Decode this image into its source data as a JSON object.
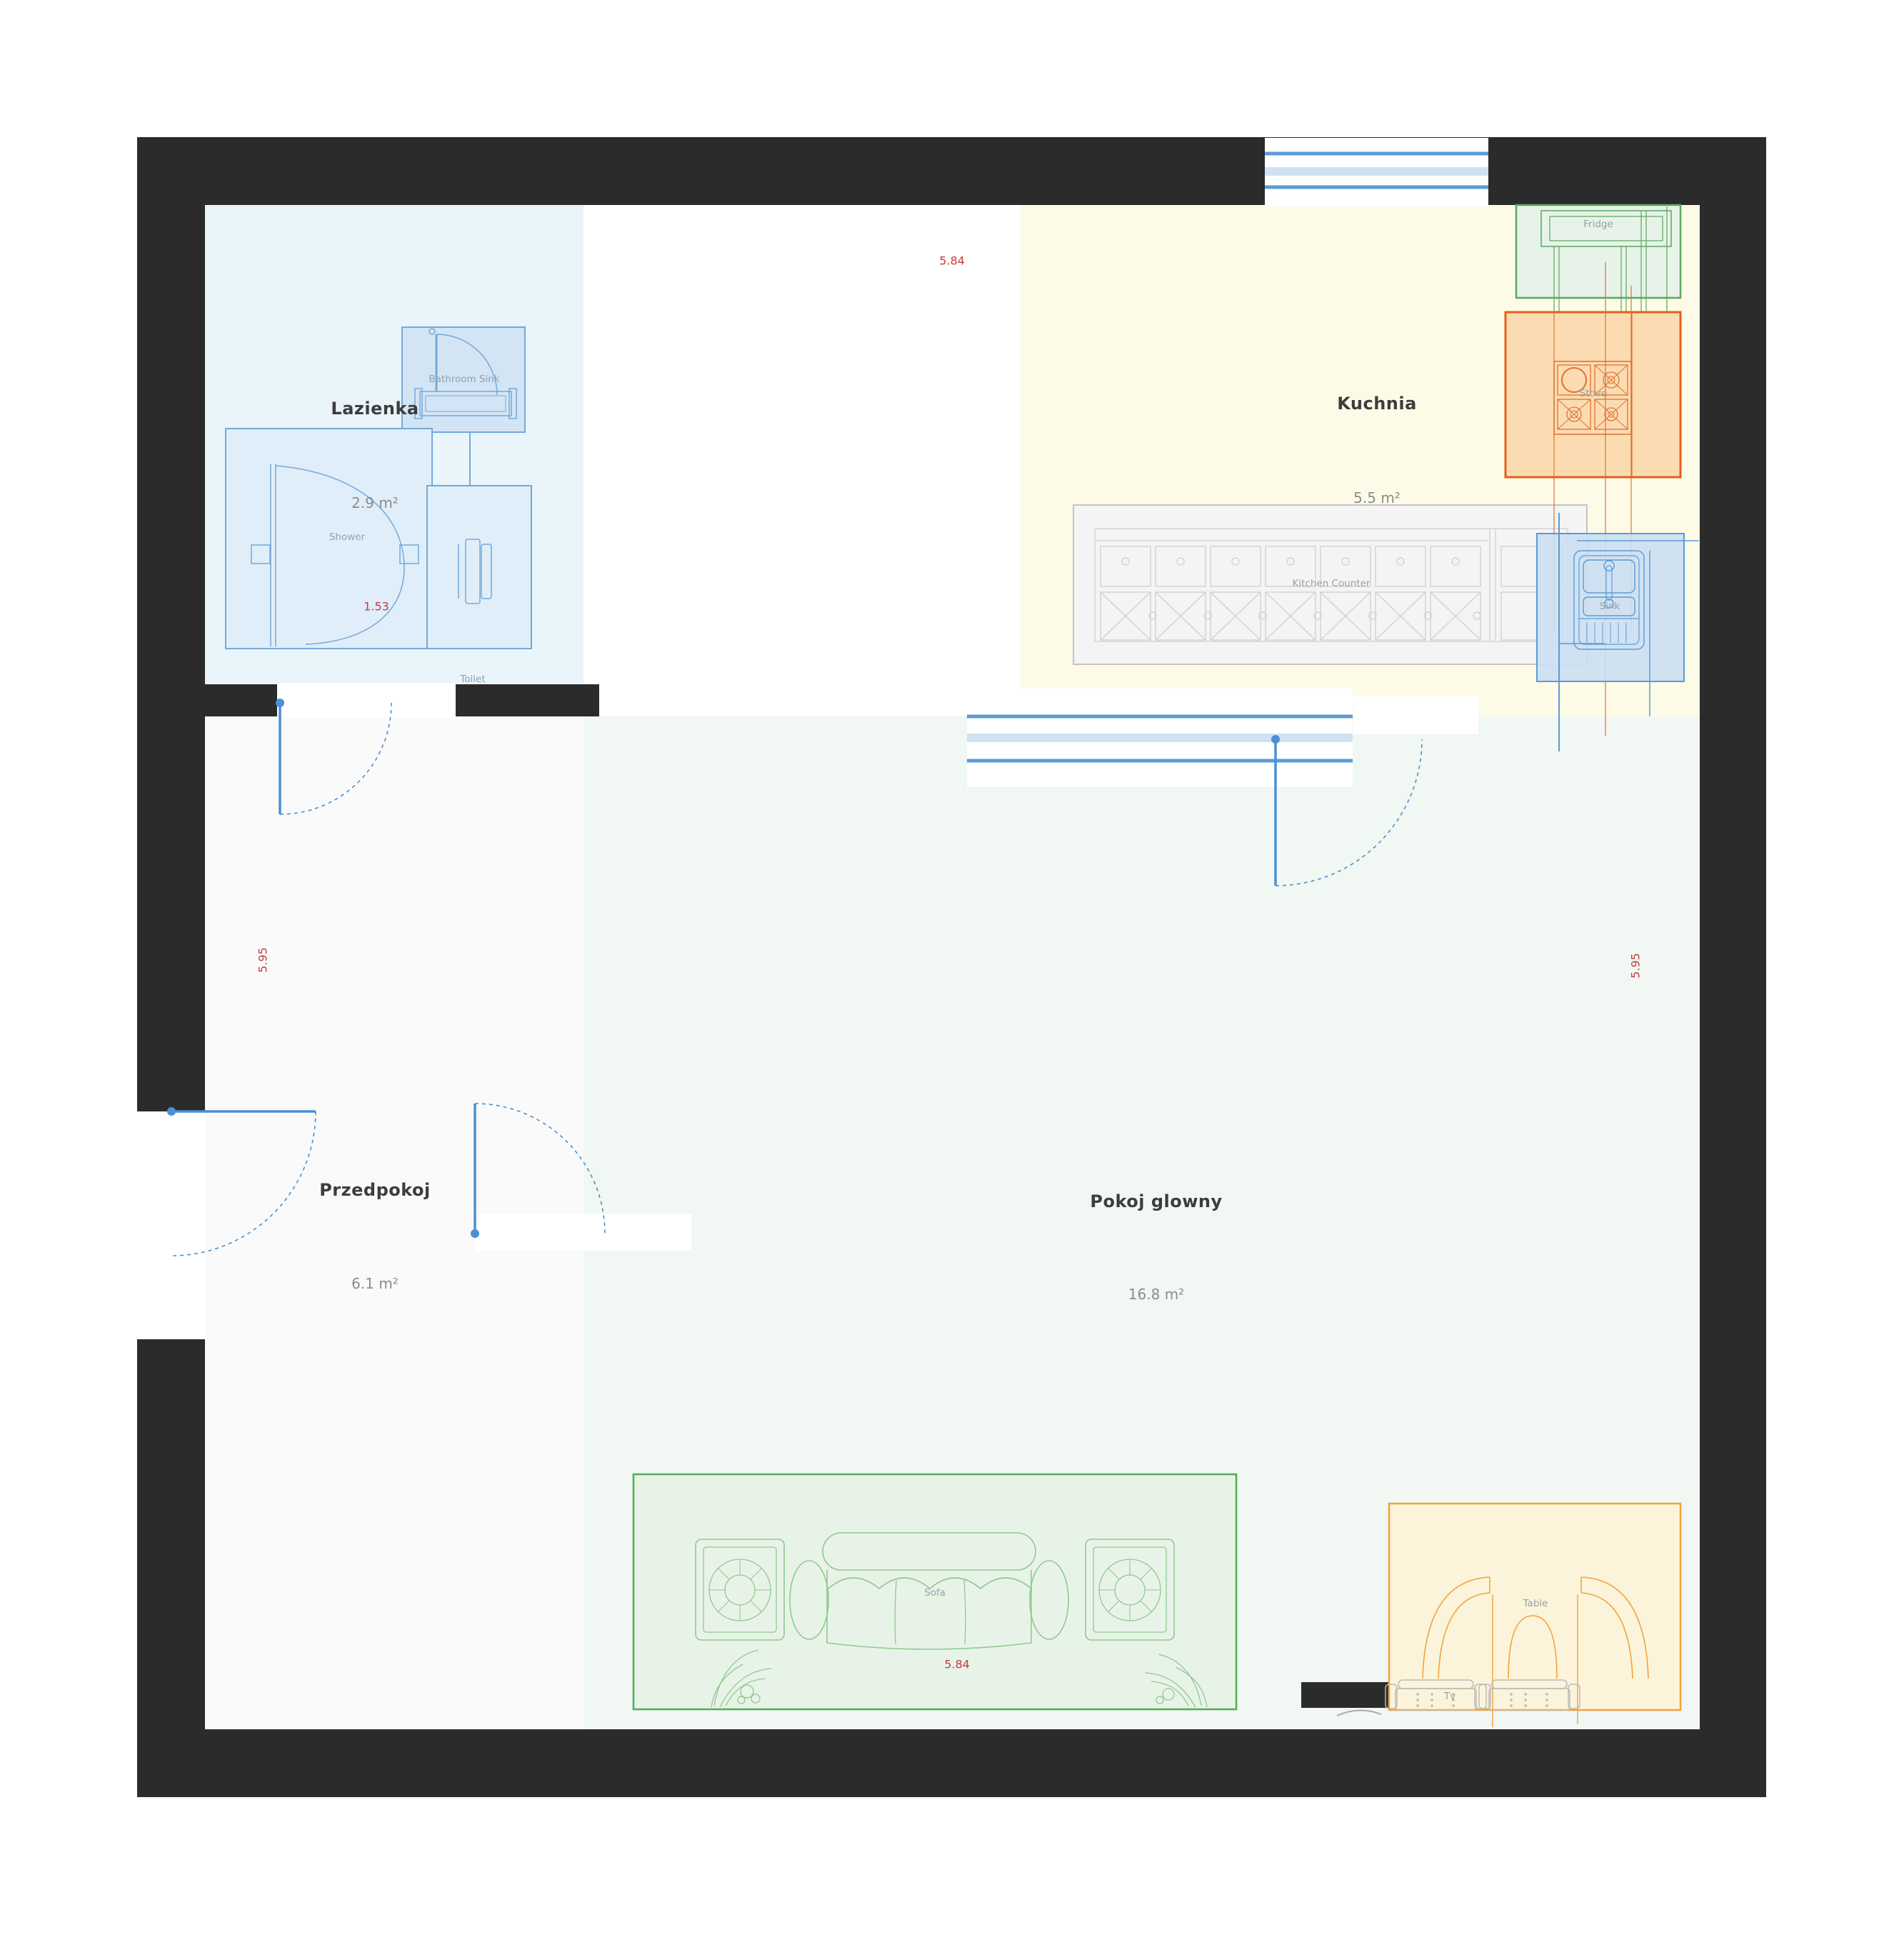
{
  "plan": {
    "rooms": [
      {
        "key": "lazienka",
        "name": "Lazienka",
        "area": "2.9 m²"
      },
      {
        "key": "kuchnia",
        "name": "Kuchnia",
        "area": "5.5 m²"
      },
      {
        "key": "przedpokoj",
        "name": "Przedpokoj",
        "area": "6.1 m²"
      },
      {
        "key": "pokoj-glowny",
        "name": "Pokoj glowny",
        "area": "16.8 m²"
      }
    ],
    "furniture": {
      "bathroom_sink": "Bathroom Sink",
      "shower": "Shower",
      "toilet": "Toilet",
      "fridge": "Fridge",
      "stove": "Stove",
      "kitchen_counter": "Kitchen Counter",
      "sink": "Sink",
      "sofa": "Sofa",
      "table": "Table",
      "tv": "Tv"
    },
    "dimensions": {
      "width_top": "5.84",
      "width_bottom": "5.84",
      "height_left": "5.95",
      "height_right": "5.95",
      "shower_width": "1.53"
    },
    "colors": {
      "wall": "#2b2b2b",
      "accent_blue": "#5b9bd5",
      "dim_red": "#c63c3c",
      "bathroom_fill": "#e9f4fb",
      "kitchen_fill": "#fdfbe7",
      "hallway_fill": "#fafafa",
      "living_fill": "#f1f7f2",
      "sofa_green": "#53ad53",
      "table_orange": "#f2a33c",
      "stove_orange": "#e55f17",
      "fridge_green": "#59a75f"
    }
  }
}
